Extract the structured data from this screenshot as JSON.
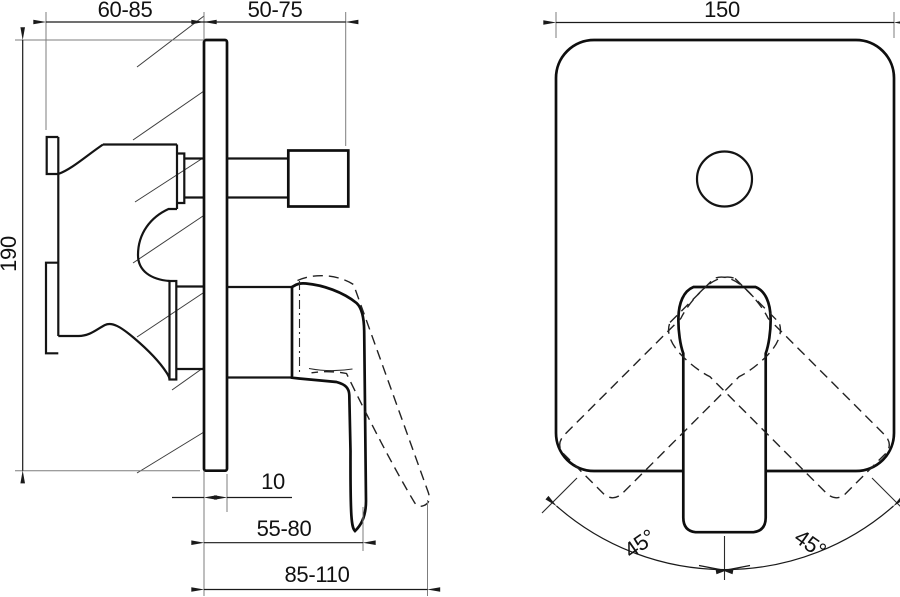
{
  "drawing": {
    "side_view": {
      "dim_body_depth": "60-85",
      "dim_knob_projection": "50-75",
      "dim_plate_height": "190",
      "dim_plate_thickness": "10",
      "dim_lever_reach_closed": "55-80",
      "dim_lever_reach_open": "85-110"
    },
    "front_view": {
      "dim_plate_width": "150",
      "dim_swing_left": "45°",
      "dim_swing_right": "45°"
    }
  },
  "colors": {
    "background": "#ffffff",
    "main_line": "#0e0e0e",
    "dimension_line": "#1a1a1a",
    "extension_line": "#7d7d7d"
  }
}
